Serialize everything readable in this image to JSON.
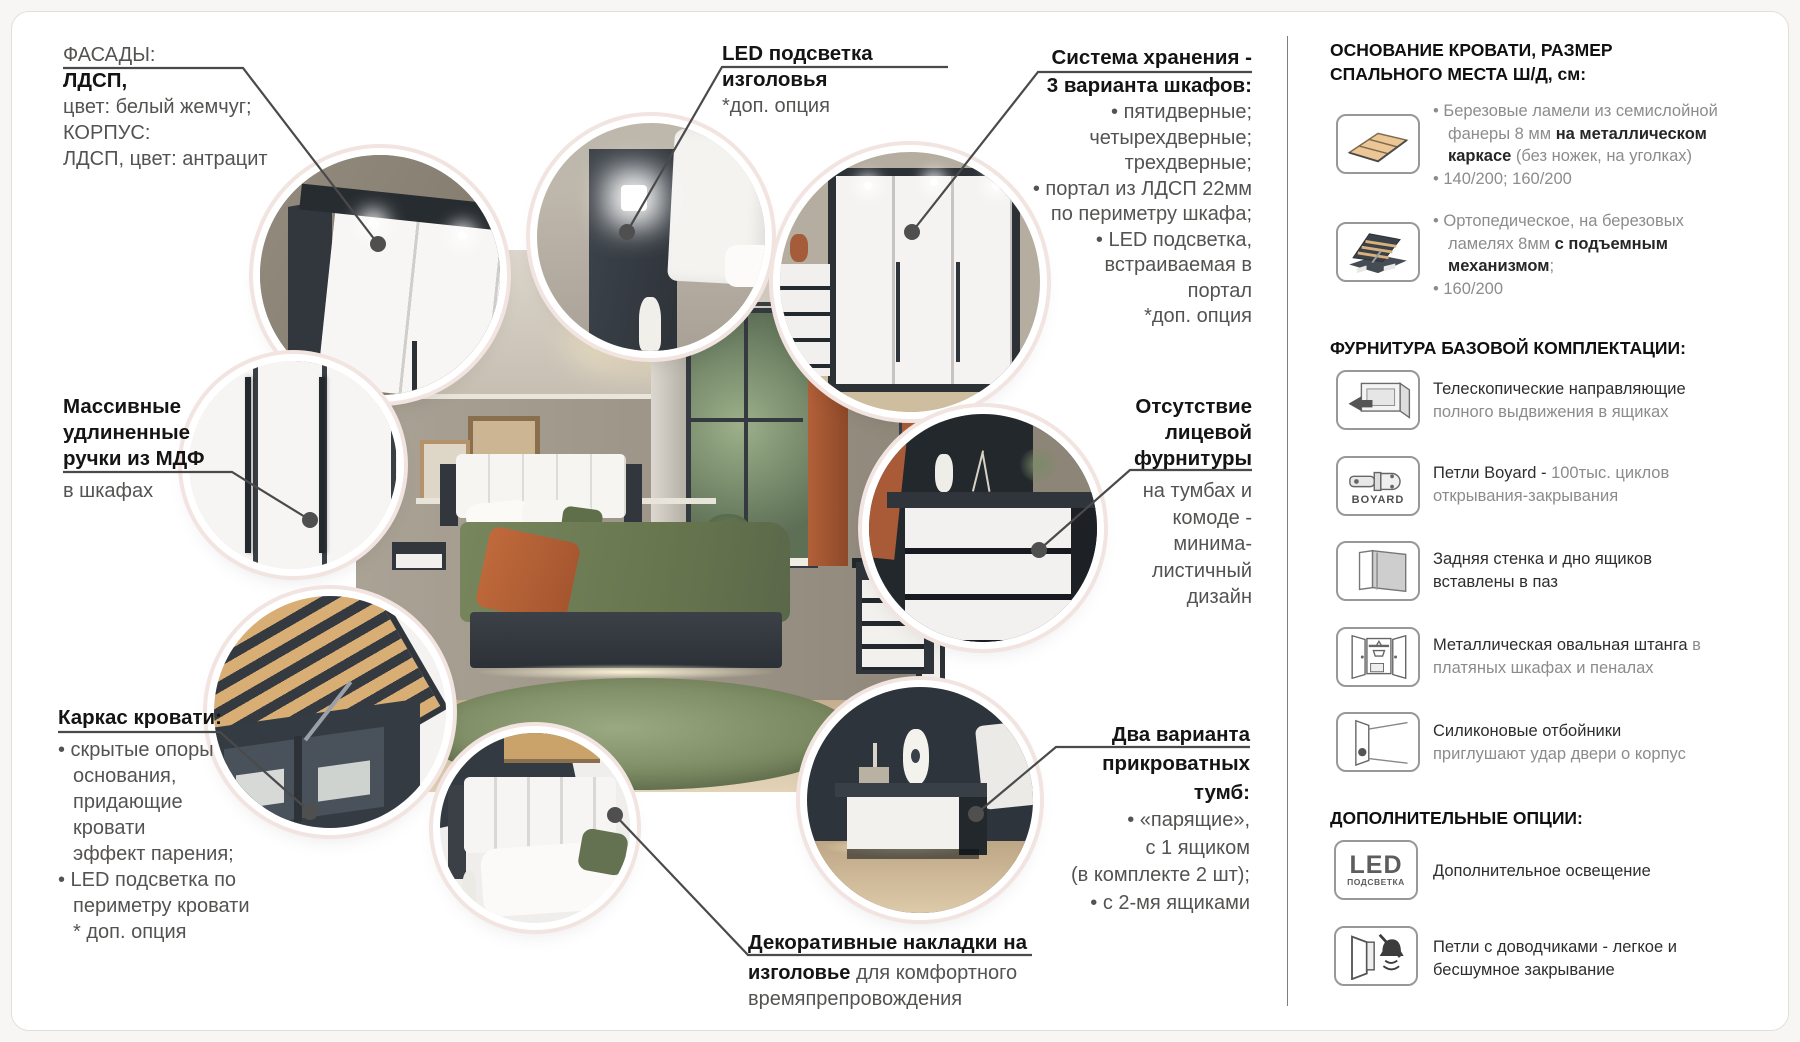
{
  "colors": {
    "ring_pink": "#f2e4e0",
    "leader_line": "#4a4a4a",
    "bold_text": "#141414",
    "regular_text": "#555351",
    "sidebar_gray": "#8c8c8c",
    "accent_orange": "#b26038",
    "furniture_dark": "#31373d",
    "rug_green": "#7c8b63"
  },
  "callouts": {
    "facades": {
      "title": "ФАСАДЫ:",
      "line1": "ЛДСП,",
      "line2": "цвет: белый жемчуг;",
      "line3": "КОРПУС:",
      "line4": "ЛДСП, цвет: антрацит"
    },
    "led_headboard": {
      "line1": "LED подсветка",
      "line2": "изголовья",
      "note": "*доп. опция"
    },
    "storage": {
      "title1": "Система хранения -",
      "title2": "3 варианта шкафов:",
      "items": [
        "• пятидверные;",
        "четырехдверные;",
        "трехдверные;",
        "• портал из ЛДСП 22мм",
        "по периметру шкафа;",
        "• LED подсветка,",
        "встраиваемая в",
        "портал",
        "*доп. опция"
      ]
    },
    "handles": {
      "bold1": "Массивные",
      "bold2": "удлиненные",
      "bold3": "ручки из МДФ",
      "rest": "в шкафах"
    },
    "no_hardware": {
      "bold1": "Отсутствие",
      "bold2": "лицевой",
      "bold3": "фурнитуры",
      "rest": [
        "на тумбах и",
        "комоде -",
        "минима-",
        "листичный",
        "дизайн"
      ]
    },
    "bed_frame": {
      "title": "Каркас кровати:",
      "items": [
        "• скрытые опоры",
        "основания,",
        "придающие",
        "кровати",
        "эффект парения;",
        "• LED подсветка по",
        "периметру кровати",
        "* доп. опция"
      ]
    },
    "headboard_pads": {
      "line1": "Декоративные накладки на",
      "line2_bold": "изголовье",
      "line2_rest": " для комфортного",
      "line3": "времяпрепровождения"
    },
    "nightstands": {
      "bold1": "Два варианта",
      "bold2": "прикроватных",
      "bold3": "тумб:",
      "items": [
        "• «парящие»,",
        "с 1 ящиком",
        "(в комплекте 2 шт);",
        "• с 2-мя ящиками"
      ]
    }
  },
  "sidebar": {
    "header_base_1": "ОСНОВАНИЕ КРОВАТИ, РАЗМЕР",
    "header_base_2": "СПАЛЬНОГО МЕСТА Ш/Д, см:",
    "base_items": [
      {
        "icon": "slat-base-icon",
        "lines": [
          [
            {
              "t": "• Березовые ламели из семислойной",
              "s": "g"
            }
          ],
          [
            {
              "t": "фанеры 8 мм ",
              "s": "g"
            },
            {
              "t": "на металлическом",
              "s": "b"
            }
          ],
          [
            {
              "t": "каркасе",
              "s": "b"
            },
            {
              "t": " (без ножек, на уголках)",
              "s": "g"
            }
          ],
          [
            {
              "t": "• 140/200; 160/200",
              "s": "g"
            }
          ]
        ]
      },
      {
        "icon": "lift-bed-icon",
        "lines": [
          [
            {
              "t": "• Ортопедическое, на березовых",
              "s": "g"
            }
          ],
          [
            {
              "t": "ламелях 8мм ",
              "s": "g"
            },
            {
              "t": "с подъемным",
              "s": "b"
            }
          ],
          [
            {
              "t": "механизмом",
              "s": "b"
            },
            {
              "t": ";",
              "s": "g"
            }
          ],
          [
            {
              "t": "• 160/200",
              "s": "g"
            }
          ]
        ]
      }
    ],
    "header_furniture": "ФУРНИТУРА БАЗОВОЙ КОМПЛЕКТАЦИИ:",
    "furniture_items": [
      {
        "icon": "drawer-slide-icon",
        "lines": [
          [
            {
              "t": "Телескопические направляющие",
              "s": "d"
            }
          ],
          [
            {
              "t": "полного выдвижения в ящиках",
              "s": "g"
            }
          ]
        ]
      },
      {
        "icon": "boyard-hinge-icon",
        "brand": "BOYARD",
        "lines": [
          [
            {
              "t": "Петли Boyard - ",
              "s": "d"
            },
            {
              "t": "100тыс. циклов",
              "s": "g"
            }
          ],
          [
            {
              "t": "открывания-закрывания",
              "s": "g"
            }
          ]
        ]
      },
      {
        "icon": "panel-groove-icon",
        "lines": [
          [
            {
              "t": "Задняя стенка и дно ящиков",
              "s": "d"
            }
          ],
          [
            {
              "t": "вставлены в паз",
              "s": "d"
            }
          ]
        ]
      },
      {
        "icon": "wardrobe-rail-icon",
        "lines": [
          [
            {
              "t": "Металлическая овальная штанга",
              "s": "d"
            },
            {
              "t": " в",
              "s": "g"
            }
          ],
          [
            {
              "t": "платяных шкафах и пеналах",
              "s": "g"
            }
          ]
        ]
      },
      {
        "icon": "silicone-bumper-icon",
        "lines": [
          [
            {
              "t": "Силиконовые отбойники",
              "s": "d"
            }
          ],
          [
            {
              "t": "приглушают удар двери о корпус",
              "s": "g"
            }
          ]
        ]
      }
    ],
    "header_options": "ДОПОЛНИТЕЛЬНЫЕ ОПЦИИ:",
    "option_items": [
      {
        "icon": "led-badge-icon",
        "badge_top": "LED",
        "badge_bottom": "ПОДСВЕТКА",
        "lines": [
          [
            {
              "t": "Дополнительное освещение",
              "s": "d"
            }
          ]
        ]
      },
      {
        "icon": "soft-close-hinge-icon",
        "lines": [
          [
            {
              "t": "Петли с доводчиками - легкое и",
              "s": "d"
            }
          ],
          [
            {
              "t": "бесшумное закрывание",
              "s": "d"
            }
          ]
        ]
      }
    ]
  }
}
